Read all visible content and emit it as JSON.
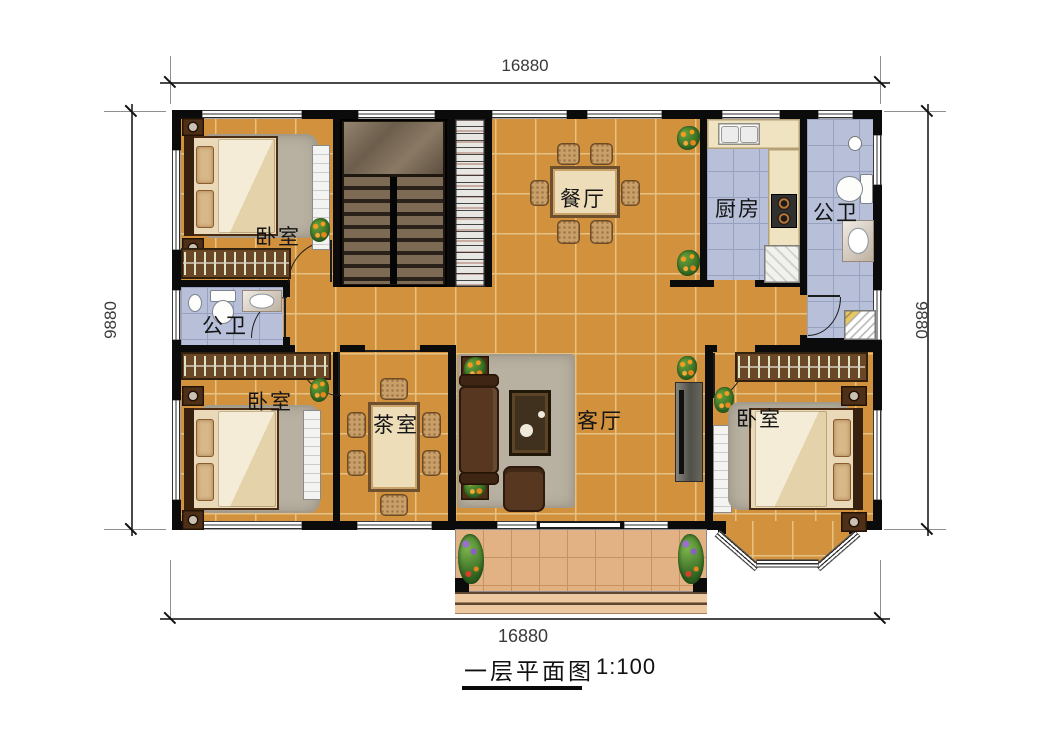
{
  "title": {
    "text": "一层平面图",
    "scale": "1:100"
  },
  "dimensions": {
    "top": "16880",
    "bottom": "16880",
    "left": "9880",
    "right": "9880"
  },
  "rooms": {
    "bedroom_tl": {
      "label": "卧室"
    },
    "bedroom_bl": {
      "label": "卧室"
    },
    "bedroom_br": {
      "label": "卧室"
    },
    "bathroom_left": {
      "label": "公卫"
    },
    "bathroom_right": {
      "label": "公卫"
    },
    "dining": {
      "label": "餐厅"
    },
    "kitchen": {
      "label": "厨房"
    },
    "tea_room": {
      "label": "茶室"
    },
    "living": {
      "label": "客厅"
    }
  },
  "colors": {
    "wall": "#0b0b0b",
    "floor_tile": "#d2913c",
    "floor_grout": "#e6c184",
    "wet_tile": "#b7c0d8",
    "wet_grout": "#97a2c0",
    "porch_tile": "#e2b285",
    "porch_grout": "#c3945f",
    "wood_dark": "#6a4827",
    "sofa_brown": "#57371f",
    "counter_cream": "#f0e3c2"
  }
}
